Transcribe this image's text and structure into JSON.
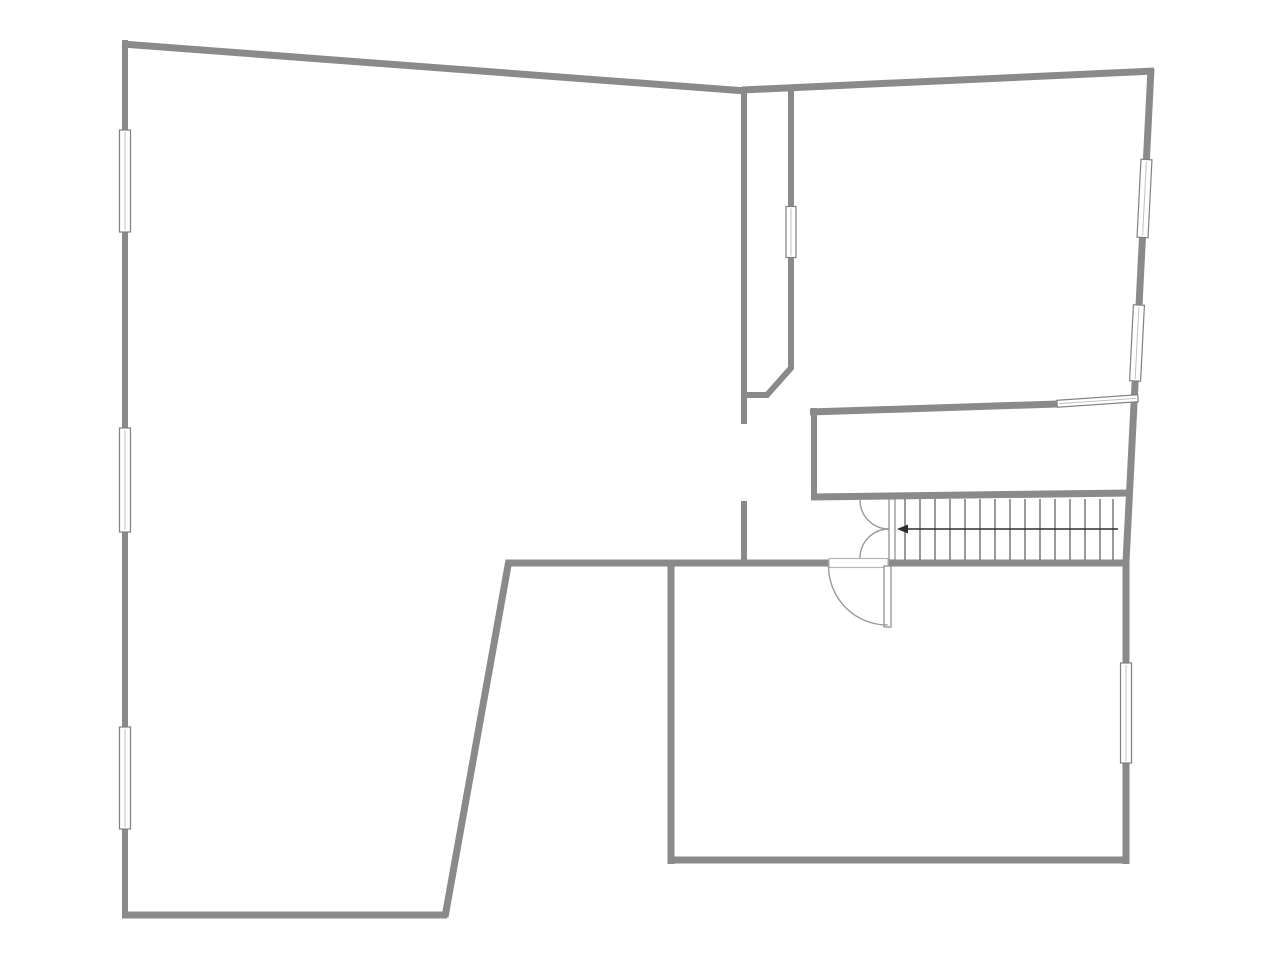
{
  "canvas": {
    "width": 1280,
    "height": 960,
    "background": "#ffffff"
  },
  "colors": {
    "wall": "#8a8a8a",
    "tread": "#646464",
    "window_border": "#808080",
    "window_fill": "#ffffff",
    "window_mid": "#c2c2c2",
    "door_arc": "#9a9a9a",
    "door_leaf_border": "#8a8a8a",
    "opening_border": "#b5b5b5",
    "arrow": "#2e2e2e"
  },
  "walls": [
    {
      "name": "exterior-wall-left",
      "w": 6,
      "pts": [
        [
          125,
          40
        ],
        [
          125,
          918
        ]
      ]
    },
    {
      "name": "exterior-wall-top-left",
      "w": 7,
      "pts": [
        [
          122,
          44
        ],
        [
          746,
          91
        ]
      ]
    },
    {
      "name": "exterior-wall-top-right",
      "w": 7,
      "pts": [
        [
          742,
          90
        ],
        [
          1154,
          71
        ]
      ]
    },
    {
      "name": "exterior-wall-right",
      "w": 7,
      "pts": [
        [
          1151,
          69
        ],
        [
          1126,
          562
        ],
        [
          1126,
          864
        ]
      ]
    },
    {
      "name": "exterior-wall-bottom-left",
      "w": 7,
      "pts": [
        [
          122,
          915
        ],
        [
          447,
          915
        ]
      ]
    },
    {
      "name": "wall-diagonal",
      "w": 7,
      "pts": [
        [
          445,
          917
        ],
        [
          509,
          560
        ]
      ]
    },
    {
      "name": "lower-room-wall-left",
      "w": 7,
      "pts": [
        [
          671,
          560
        ],
        [
          671,
          864
        ]
      ]
    },
    {
      "name": "lower-room-wall-bottom",
      "w": 7,
      "pts": [
        [
          668,
          860
        ],
        [
          1129,
          860
        ]
      ]
    },
    {
      "name": "mid-wall-west",
      "w": 7,
      "pts": [
        [
          507,
          563
        ],
        [
          830,
          563
        ]
      ]
    },
    {
      "name": "mid-wall-east",
      "w": 7,
      "pts": [
        [
          886,
          563
        ],
        [
          1129,
          563
        ]
      ]
    },
    {
      "name": "hallway-wall-west",
      "w": 6,
      "pts": [
        [
          744,
          87
        ],
        [
          744,
          424
        ]
      ]
    },
    {
      "name": "hallway-wall-west-stub",
      "w": 6,
      "pts": [
        [
          744,
          501
        ],
        [
          744,
          566
        ]
      ]
    },
    {
      "name": "hallway-wall-east-upper",
      "w": 6,
      "pts": [
        [
          791,
          87
        ],
        [
          791,
          208
        ]
      ]
    },
    {
      "name": "hallway-wall-east-lower",
      "w": 6,
      "pts": [
        [
          791,
          256
        ],
        [
          791,
          368
        ],
        [
          767,
          395
        ],
        [
          745,
          395
        ]
      ]
    },
    {
      "name": "closet-wall-top-slanted",
      "w": 7,
      "pts": [
        [
          810,
          412
        ],
        [
          1057,
          404
        ]
      ]
    },
    {
      "name": "closet-wall-left",
      "w": 6,
      "pts": [
        [
          814,
          408
        ],
        [
          814,
          500
        ]
      ]
    },
    {
      "name": "stairs-top-wall",
      "w": 7,
      "pts": [
        [
          811,
          497
        ],
        [
          1131,
          493
        ]
      ]
    }
  ],
  "windows": [
    {
      "name": "window-left-1",
      "cx": 125,
      "cy": 181,
      "len": 102,
      "th": 11,
      "angle": 90
    },
    {
      "name": "window-left-2",
      "cx": 125,
      "cy": 480,
      "len": 104,
      "th": 11,
      "angle": 90
    },
    {
      "name": "window-left-3",
      "cx": 125,
      "cy": 778,
      "len": 102,
      "th": 11,
      "angle": 90
    },
    {
      "name": "window-hallway",
      "cx": 791,
      "cy": 232,
      "len": 51,
      "th": 10,
      "angle": 90
    },
    {
      "name": "window-right-1",
      "cx": 1144.5,
      "cy": 198.5,
      "len": 78,
      "th": 11,
      "angle": 92.9
    },
    {
      "name": "window-right-2",
      "cx": 1137,
      "cy": 343,
      "len": 76,
      "th": 11,
      "angle": 92.9
    },
    {
      "name": "window-right-3",
      "cx": 1126,
      "cy": 713,
      "len": 100,
      "th": 11,
      "angle": 90
    },
    {
      "name": "window-closet",
      "cx": 1097.5,
      "cy": 401,
      "len": 81,
      "th": 7,
      "angle": -3.9
    }
  ],
  "stairs": {
    "tread_y1": 499,
    "tread_y2": 560,
    "treads_x": [
      905,
      920,
      935,
      950,
      965,
      980,
      995,
      1010,
      1025,
      1040,
      1055,
      1070,
      1085,
      1100,
      1113
    ],
    "edge": {
      "x": 889,
      "y": 499,
      "w": 6,
      "h": 61
    }
  },
  "door_rects": [
    {
      "name": "room-door-opening",
      "x": 829,
      "y": 558.5,
      "w": 59,
      "h": 9,
      "border": "opening_border"
    },
    {
      "name": "room-door-leaf",
      "x": 884,
      "y": 566,
      "w": 7,
      "h": 61,
      "border": "door_leaf_border"
    }
  ],
  "door_arcs": [
    {
      "name": "stair-double-door-upper-arc",
      "path": "M 889 529 A 29 29 0 0 1 860 500"
    },
    {
      "name": "stair-double-door-lower-arc",
      "path": "M 889 529 A 29 29 0 0 0 860 558"
    },
    {
      "name": "room-door-arc",
      "path": "M 887.5 625 A 59 59 0 0 1 828.5 566"
    }
  ],
  "arrow": {
    "name": "stair-direction-arrow",
    "shaft": {
      "x1": 902,
      "y1": 529,
      "x2": 1118,
      "y2": 529
    },
    "head": [
      [
        897,
        529
      ],
      [
        908,
        524.5
      ],
      [
        908,
        533.5
      ]
    ]
  }
}
